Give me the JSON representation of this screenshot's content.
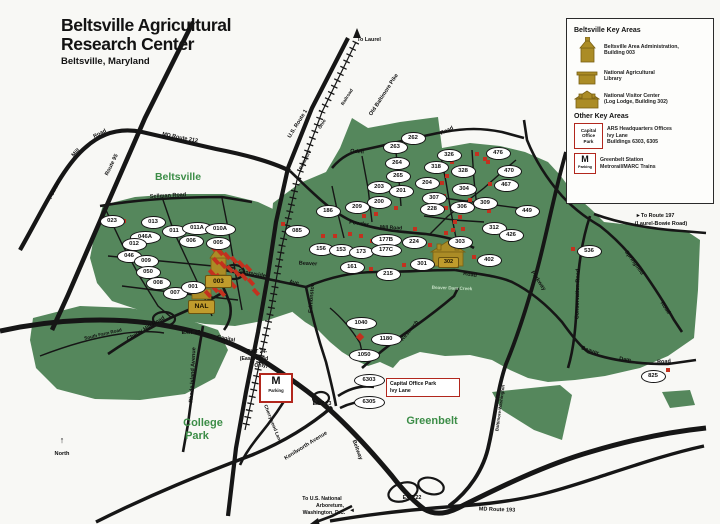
{
  "title": {
    "line1": "Beltsville Agricultural",
    "line2": "Research Center",
    "subtitle": "Beltsville, Maryland"
  },
  "colors": {
    "land_green": "#55875c",
    "area_text_green": "#3c8d47",
    "gold": "#ab8c26",
    "red_marker": "#c3311f",
    "road_black": "#161616",
    "metro_red": "#b2271d"
  },
  "legend": {
    "title": "Beltsville Key Areas",
    "items": [
      {
        "icon": "admin-building-icon",
        "lines": [
          "Beltsville Area Administration,",
          "Building 003"
        ]
      },
      {
        "icon": "library-building-icon",
        "lines": [
          "National Agricultural",
          "Library"
        ]
      },
      {
        "icon": "log-lodge-icon",
        "lines": [
          "National Visitor Center",
          "(Log Lodge, Building 302)"
        ]
      }
    ],
    "subtitle": "Other Key Areas",
    "other_items": [
      {
        "icon": "capital-office-park-box",
        "box_lines": [
          "Capital",
          "Office",
          "Park"
        ],
        "lines": [
          "ARS Headquarters Offices",
          "Ivy Lane",
          "Buildings 6303, 6305"
        ]
      },
      {
        "icon": "metro-parking-box",
        "box_lines": [
          "M",
          "Parking"
        ],
        "lines": [
          "Greenbelt Station",
          "Metrorail/MARC Trains"
        ]
      }
    ]
  },
  "gold_sites": {
    "admin": {
      "label": "003"
    },
    "nal": {
      "label": "NAL"
    },
    "lodge": {
      "label": "302"
    }
  },
  "map_boxes": {
    "metro": {
      "m": "M",
      "parking": "Parking"
    },
    "callout": {
      "line1": "Capital Office Park",
      "line2": "Ivy Lane"
    }
  },
  "area_labels": [
    {
      "t": "Beltsville",
      "x": 178,
      "y": 177,
      "s": 10.5
    },
    {
      "t": "College",
      "x": 203,
      "y": 423,
      "s": 11
    },
    {
      "t": "Park",
      "x": 197,
      "y": 436,
      "s": 11
    },
    {
      "t": "Greenbelt",
      "x": 432,
      "y": 421,
      "s": 11
    }
  ],
  "buildings": [
    {
      "label": "023",
      "x": 111,
      "y": 221
    },
    {
      "label": "013",
      "x": 152,
      "y": 222
    },
    {
      "label": "046A",
      "x": 144,
      "y": 237
    },
    {
      "label": "011",
      "x": 173,
      "y": 231
    },
    {
      "label": "011A",
      "x": 196,
      "y": 228
    },
    {
      "label": "010A",
      "x": 219,
      "y": 229
    },
    {
      "label": "012",
      "x": 133,
      "y": 244
    },
    {
      "label": "006",
      "x": 190,
      "y": 241
    },
    {
      "label": "005",
      "x": 217,
      "y": 243
    },
    {
      "label": "046",
      "x": 128,
      "y": 256
    },
    {
      "label": "009",
      "x": 145,
      "y": 261
    },
    {
      "label": "050",
      "x": 147,
      "y": 272
    },
    {
      "label": "008",
      "x": 157,
      "y": 283
    },
    {
      "label": "007",
      "x": 174,
      "y": 293
    },
    {
      "label": "001",
      "x": 192,
      "y": 287
    },
    {
      "label": "085",
      "x": 296,
      "y": 231
    },
    {
      "label": "156",
      "x": 320,
      "y": 249
    },
    {
      "label": "153",
      "x": 340,
      "y": 250
    },
    {
      "label": "173",
      "x": 360,
      "y": 252
    },
    {
      "label": "177B",
      "x": 385,
      "y": 240
    },
    {
      "label": "177C",
      "x": 385,
      "y": 250
    },
    {
      "label": "224",
      "x": 413,
      "y": 242
    },
    {
      "label": "161",
      "x": 351,
      "y": 267
    },
    {
      "label": "215",
      "x": 387,
      "y": 274
    },
    {
      "label": "186",
      "x": 327,
      "y": 211
    },
    {
      "label": "209",
      "x": 356,
      "y": 207
    },
    {
      "label": "200",
      "x": 378,
      "y": 202
    },
    {
      "label": "203",
      "x": 378,
      "y": 187
    },
    {
      "label": "201",
      "x": 400,
      "y": 191
    },
    {
      "label": "262",
      "x": 412,
      "y": 138
    },
    {
      "label": "263",
      "x": 394,
      "y": 147
    },
    {
      "label": "264",
      "x": 396,
      "y": 163
    },
    {
      "label": "265",
      "x": 397,
      "y": 176
    },
    {
      "label": "326",
      "x": 448,
      "y": 155
    },
    {
      "label": "318",
      "x": 435,
      "y": 167
    },
    {
      "label": "328",
      "x": 462,
      "y": 171
    },
    {
      "label": "204",
      "x": 426,
      "y": 183
    },
    {
      "label": "304",
      "x": 463,
      "y": 189
    },
    {
      "label": "307",
      "x": 433,
      "y": 198
    },
    {
      "label": "306",
      "x": 461,
      "y": 207
    },
    {
      "label": "309",
      "x": 484,
      "y": 203
    },
    {
      "label": "228",
      "x": 431,
      "y": 209
    },
    {
      "label": "476",
      "x": 497,
      "y": 153
    },
    {
      "label": "470",
      "x": 508,
      "y": 171
    },
    {
      "label": "467",
      "x": 505,
      "y": 185
    },
    {
      "label": "449",
      "x": 526,
      "y": 211
    },
    {
      "label": "312",
      "x": 493,
      "y": 228
    },
    {
      "label": "426",
      "x": 510,
      "y": 235
    },
    {
      "label": "303",
      "x": 459,
      "y": 242
    },
    {
      "label": "301",
      "x": 421,
      "y": 264
    },
    {
      "label": "402",
      "x": 488,
      "y": 260
    },
    {
      "label": "536",
      "x": 588,
      "y": 251
    },
    {
      "label": "825",
      "x": 652,
      "y": 376
    },
    {
      "label": "1040",
      "x": 360,
      "y": 323
    },
    {
      "label": "1180",
      "x": 385,
      "y": 339
    },
    {
      "label": "1050",
      "x": 363,
      "y": 355
    },
    {
      "label": "6303",
      "x": 368,
      "y": 380
    },
    {
      "label": "6305",
      "x": 368,
      "y": 402
    }
  ],
  "road_labels": [
    {
      "t": "MD Route 212",
      "x": 180,
      "y": 138,
      "r": 11
    },
    {
      "t": "Powder",
      "x": 55,
      "y": 190,
      "r": -63
    },
    {
      "t": "Mill",
      "x": 76,
      "y": 153,
      "r": -45
    },
    {
      "t": "Road",
      "x": 100,
      "y": 134,
      "r": -28
    },
    {
      "t": "Route 95",
      "x": 112,
      "y": 165,
      "r": -64
    },
    {
      "t": "Sellman Road",
      "x": 168,
      "y": 196,
      "r": -3
    },
    {
      "t": "U.S. Route 1",
      "x": 298,
      "y": 124,
      "r": -58
    },
    {
      "t": "Baltimore",
      "x": 305,
      "y": 160,
      "r": -63,
      "s": 4.6
    },
    {
      "t": "Ohio",
      "x": 322,
      "y": 124,
      "r": -58,
      "s": 4.6
    },
    {
      "t": "Railroad",
      "x": 347,
      "y": 97,
      "r": -58,
      "s": 4.6
    },
    {
      "t": "Old Baltimore Pike",
      "x": 384,
      "y": 95,
      "r": -57
    },
    {
      "t": "Odell",
      "x": 357,
      "y": 152,
      "r": 4
    },
    {
      "t": "Road",
      "x": 447,
      "y": 131,
      "r": -26
    },
    {
      "t": "Powder",
      "x": 359,
      "y": 224,
      "r": 8
    },
    {
      "t": "Mill Road",
      "x": 391,
      "y": 228,
      "r": 3,
      "s": 5
    },
    {
      "t": "Springfield",
      "x": 634,
      "y": 263,
      "r": 54
    },
    {
      "t": "Road",
      "x": 665,
      "y": 308,
      "r": 56
    },
    {
      "t": "Conservation Road",
      "x": 578,
      "y": 294,
      "r": -89
    },
    {
      "t": "Parkway",
      "x": 538,
      "y": 281,
      "r": 56
    },
    {
      "t": "Baltimore-Washington",
      "x": 500,
      "y": 408,
      "r": -82,
      "s": 4.4
    },
    {
      "t": "Beaver",
      "x": 308,
      "y": 264,
      "r": 3
    },
    {
      "t": "Beaver",
      "x": 590,
      "y": 351,
      "r": 18
    },
    {
      "t": "Dam",
      "x": 625,
      "y": 360,
      "r": 8
    },
    {
      "t": "Road",
      "x": 664,
      "y": 362,
      "r": -4
    },
    {
      "t": "Road",
      "x": 470,
      "y": 275,
      "r": 8
    },
    {
      "t": "Beaver Dam Creek",
      "x": 452,
      "y": 288,
      "r": 2,
      "s": 4.6,
      "c": "#c6e0c6"
    },
    {
      "t": "Research",
      "x": 410,
      "y": 331,
      "r": -50
    },
    {
      "t": "Edmonston",
      "x": 312,
      "y": 298,
      "r": -86
    },
    {
      "t": "Sunnyside",
      "x": 252,
      "y": 274,
      "r": 10
    },
    {
      "t": "Ave",
      "x": 294,
      "y": 283,
      "r": 10
    },
    {
      "t": "Rhode Island Avenue",
      "x": 193,
      "y": 375,
      "r": -87
    },
    {
      "t": "Cherry Hill Road",
      "x": 146,
      "y": 329,
      "r": -31
    },
    {
      "t": "South Farm Road",
      "x": 103,
      "y": 334,
      "r": -13,
      "s": 4.6
    },
    {
      "t": "Capital",
      "x": 226,
      "y": 339,
      "r": 11
    },
    {
      "t": "Beltway",
      "x": 357,
      "y": 450,
      "r": 70
    },
    {
      "t": "Kenilworth Avenue",
      "x": 306,
      "y": 446,
      "r": -32
    },
    {
      "t": "Cherrywood Lane",
      "x": 272,
      "y": 424,
      "r": 68,
      "s": 4.8
    },
    {
      "t": "MD Route 193",
      "x": 497,
      "y": 510,
      "r": 2
    }
  ],
  "exits": [
    {
      "t": "EXIT 25",
      "x": 191,
      "y": 333
    },
    {
      "t": "EXIT 24-",
      "x": 257,
      "y": 352
    },
    {
      "t": "(Eastbound",
      "x": 254,
      "y": 359
    },
    {
      "t": "Only)",
      "x": 261,
      "y": 366
    },
    {
      "t": "EXIT 23",
      "x": 322,
      "y": 404
    },
    {
      "t": "EXIT 22",
      "x": 412,
      "y": 498
    }
  ],
  "notes": [
    {
      "t": "To Laurel",
      "x": 369,
      "y": 40,
      "s": 5.4
    },
    {
      "t": "►To Route 197",
      "x": 655,
      "y": 216,
      "s": 5.4
    },
    {
      "t": "(Laurel-Bowie Road)",
      "x": 661,
      "y": 224,
      "s": 5.4
    },
    {
      "t": "To U.S. National",
      "x": 322,
      "y": 499,
      "s": 5.2
    },
    {
      "t": "Arboretum,",
      "x": 330,
      "y": 506,
      "s": 5.2
    },
    {
      "t": "Washington, D.C.",
      "x": 324,
      "y": 513,
      "s": 5.2
    },
    {
      "t": "◄",
      "x": 352,
      "y": 511,
      "s": 6
    },
    {
      "t": "↑",
      "x": 62,
      "y": 440,
      "s": 9
    },
    {
      "t": "North",
      "x": 62,
      "y": 454,
      "s": 5.6
    }
  ],
  "red_markers": [
    [
      213,
      248,
      -42,
      4,
      8
    ],
    [
      220,
      252,
      -42,
      4,
      8
    ],
    [
      227,
      256,
      -42,
      4,
      8
    ],
    [
      234,
      260,
      -42,
      4,
      8
    ],
    [
      241,
      264,
      -42,
      4,
      8
    ],
    [
      248,
      268,
      -42,
      4,
      8
    ],
    [
      216,
      261,
      -42,
      4,
      8
    ],
    [
      223,
      265,
      -42,
      4,
      8
    ],
    [
      230,
      269,
      -42,
      4,
      8
    ],
    [
      237,
      273,
      -42,
      4,
      8
    ],
    [
      244,
      277,
      -42,
      4,
      8
    ],
    [
      212,
      273,
      -42,
      4,
      8
    ],
    [
      219,
      277,
      -42,
      4,
      8
    ],
    [
      226,
      281,
      -42,
      4,
      8
    ],
    [
      233,
      285,
      -42,
      4,
      8
    ],
    [
      215,
      289,
      -42,
      4,
      8
    ],
    [
      222,
      293,
      -42,
      4,
      8
    ],
    [
      208,
      294,
      -42,
      4,
      8
    ],
    [
      251,
      282,
      -42,
      4,
      8
    ],
    [
      256,
      292,
      -42,
      4,
      8
    ],
    [
      124,
      221
    ],
    [
      283,
      224
    ],
    [
      364,
      216
    ],
    [
      376,
      214
    ],
    [
      323,
      236
    ],
    [
      335,
      236
    ],
    [
      350,
      234
    ],
    [
      361,
      236
    ],
    [
      372,
      241
    ],
    [
      415,
      229
    ],
    [
      365,
      255
    ],
    [
      371,
      269
    ],
    [
      404,
      265
    ],
    [
      438,
      168
    ],
    [
      442,
      183
    ],
    [
      444,
      196
    ],
    [
      446,
      208
    ],
    [
      460,
      217
    ],
    [
      463,
      229
    ],
    [
      477,
      154
    ],
    [
      485,
      159
    ],
    [
      488,
      162
    ],
    [
      502,
      172
    ],
    [
      490,
      184
    ],
    [
      453,
      230
    ],
    [
      430,
      245
    ],
    [
      474,
      257
    ],
    [
      573,
      249
    ],
    [
      668,
      370
    ],
    [
      407,
      191
    ],
    [
      396,
      208
    ],
    [
      452,
      162
    ],
    [
      447,
      176
    ],
    [
      470,
      200
    ],
    [
      455,
      222
    ],
    [
      446,
      233
    ],
    [
      489,
      211
    ],
    [
      360,
      337,
      45,
      6,
      6
    ]
  ]
}
